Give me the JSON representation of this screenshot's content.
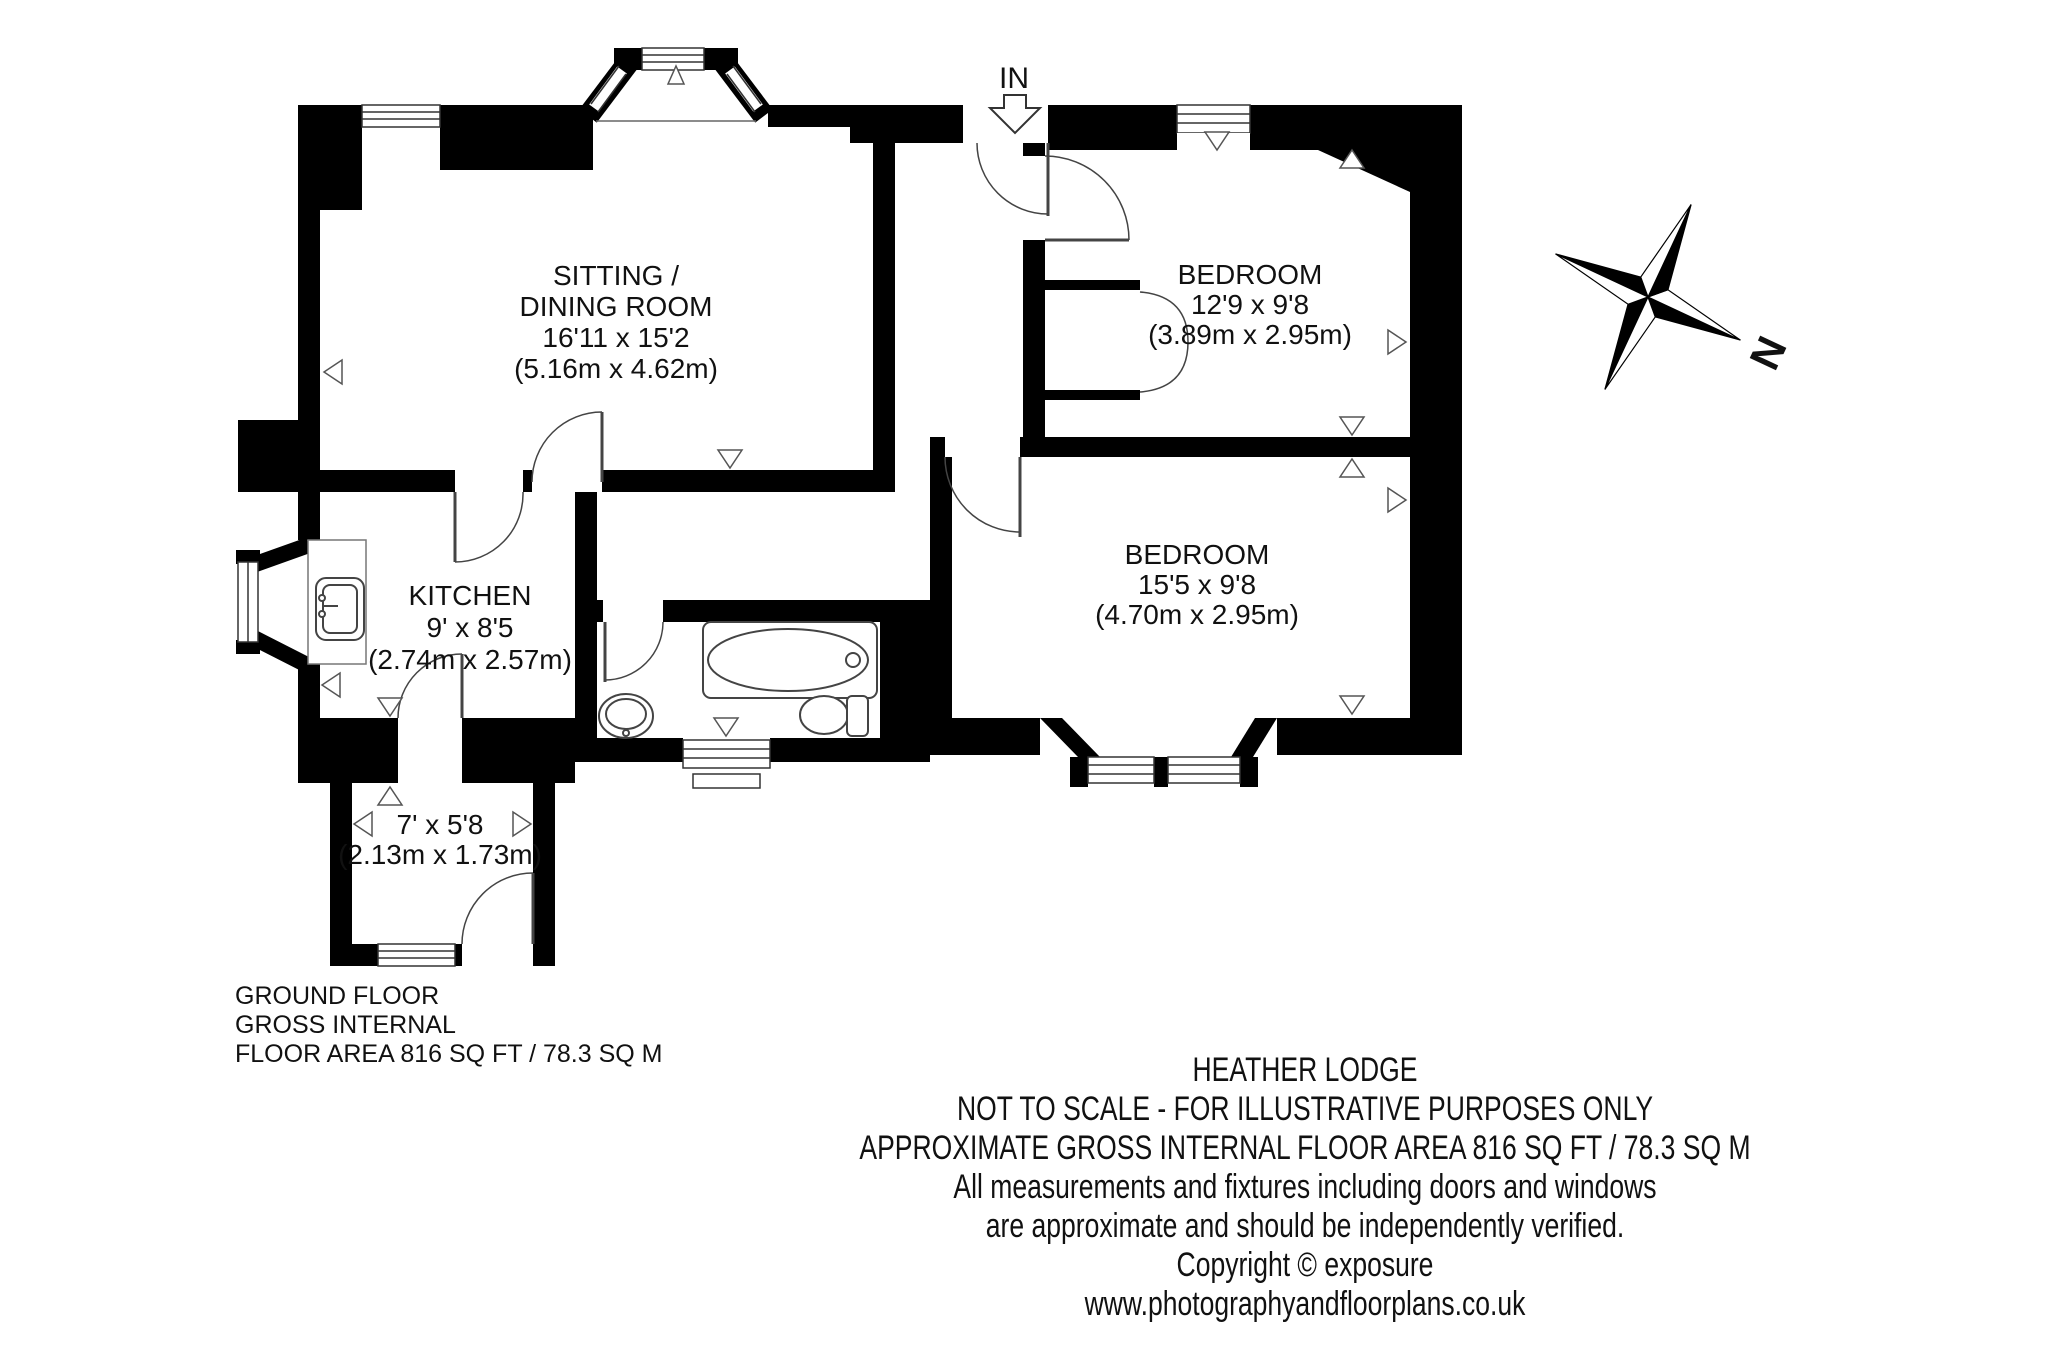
{
  "plan": {
    "entrance_label": "IN",
    "compass_label": "N",
    "rooms": {
      "sitting": {
        "lines": [
          "SITTING /",
          "DINING ROOM",
          "16'11 x 15'2",
          "(5.16m x 4.62m)"
        ]
      },
      "bedroom1": {
        "lines": [
          "BEDROOM",
          "12'9 x 9'8",
          "(3.89m x 2.95m)"
        ]
      },
      "bedroom2": {
        "lines": [
          "BEDROOM",
          "15'5 x 9'8",
          "(4.70m x 2.95m)"
        ]
      },
      "kitchen": {
        "lines": [
          "KITCHEN",
          "9' x 8'5",
          "(2.74m x 2.57m)"
        ]
      },
      "porch": {
        "lines": [
          "7' x 5'8",
          "(2.13m x 1.73m)"
        ]
      }
    }
  },
  "footer_left": {
    "lines": [
      "GROUND FLOOR",
      "GROSS INTERNAL",
      "FLOOR AREA 816 SQ FT / 78.3 SQ M"
    ]
  },
  "footer_center": {
    "lines": [
      "HEATHER LODGE",
      "NOT TO SCALE - FOR ILLUSTRATIVE PURPOSES ONLY",
      "APPROXIMATE GROSS INTERNAL FLOOR AREA 816 SQ FT / 78.3 SQ M",
      "All measurements and fixtures including doors and windows",
      "are approximate and should be independently verified.",
      "Copyright © exposure",
      "www.photographyandfloorplans.co.uk"
    ]
  },
  "colors": {
    "wall": "#000000",
    "line": "#444444",
    "background": "#ffffff"
  }
}
